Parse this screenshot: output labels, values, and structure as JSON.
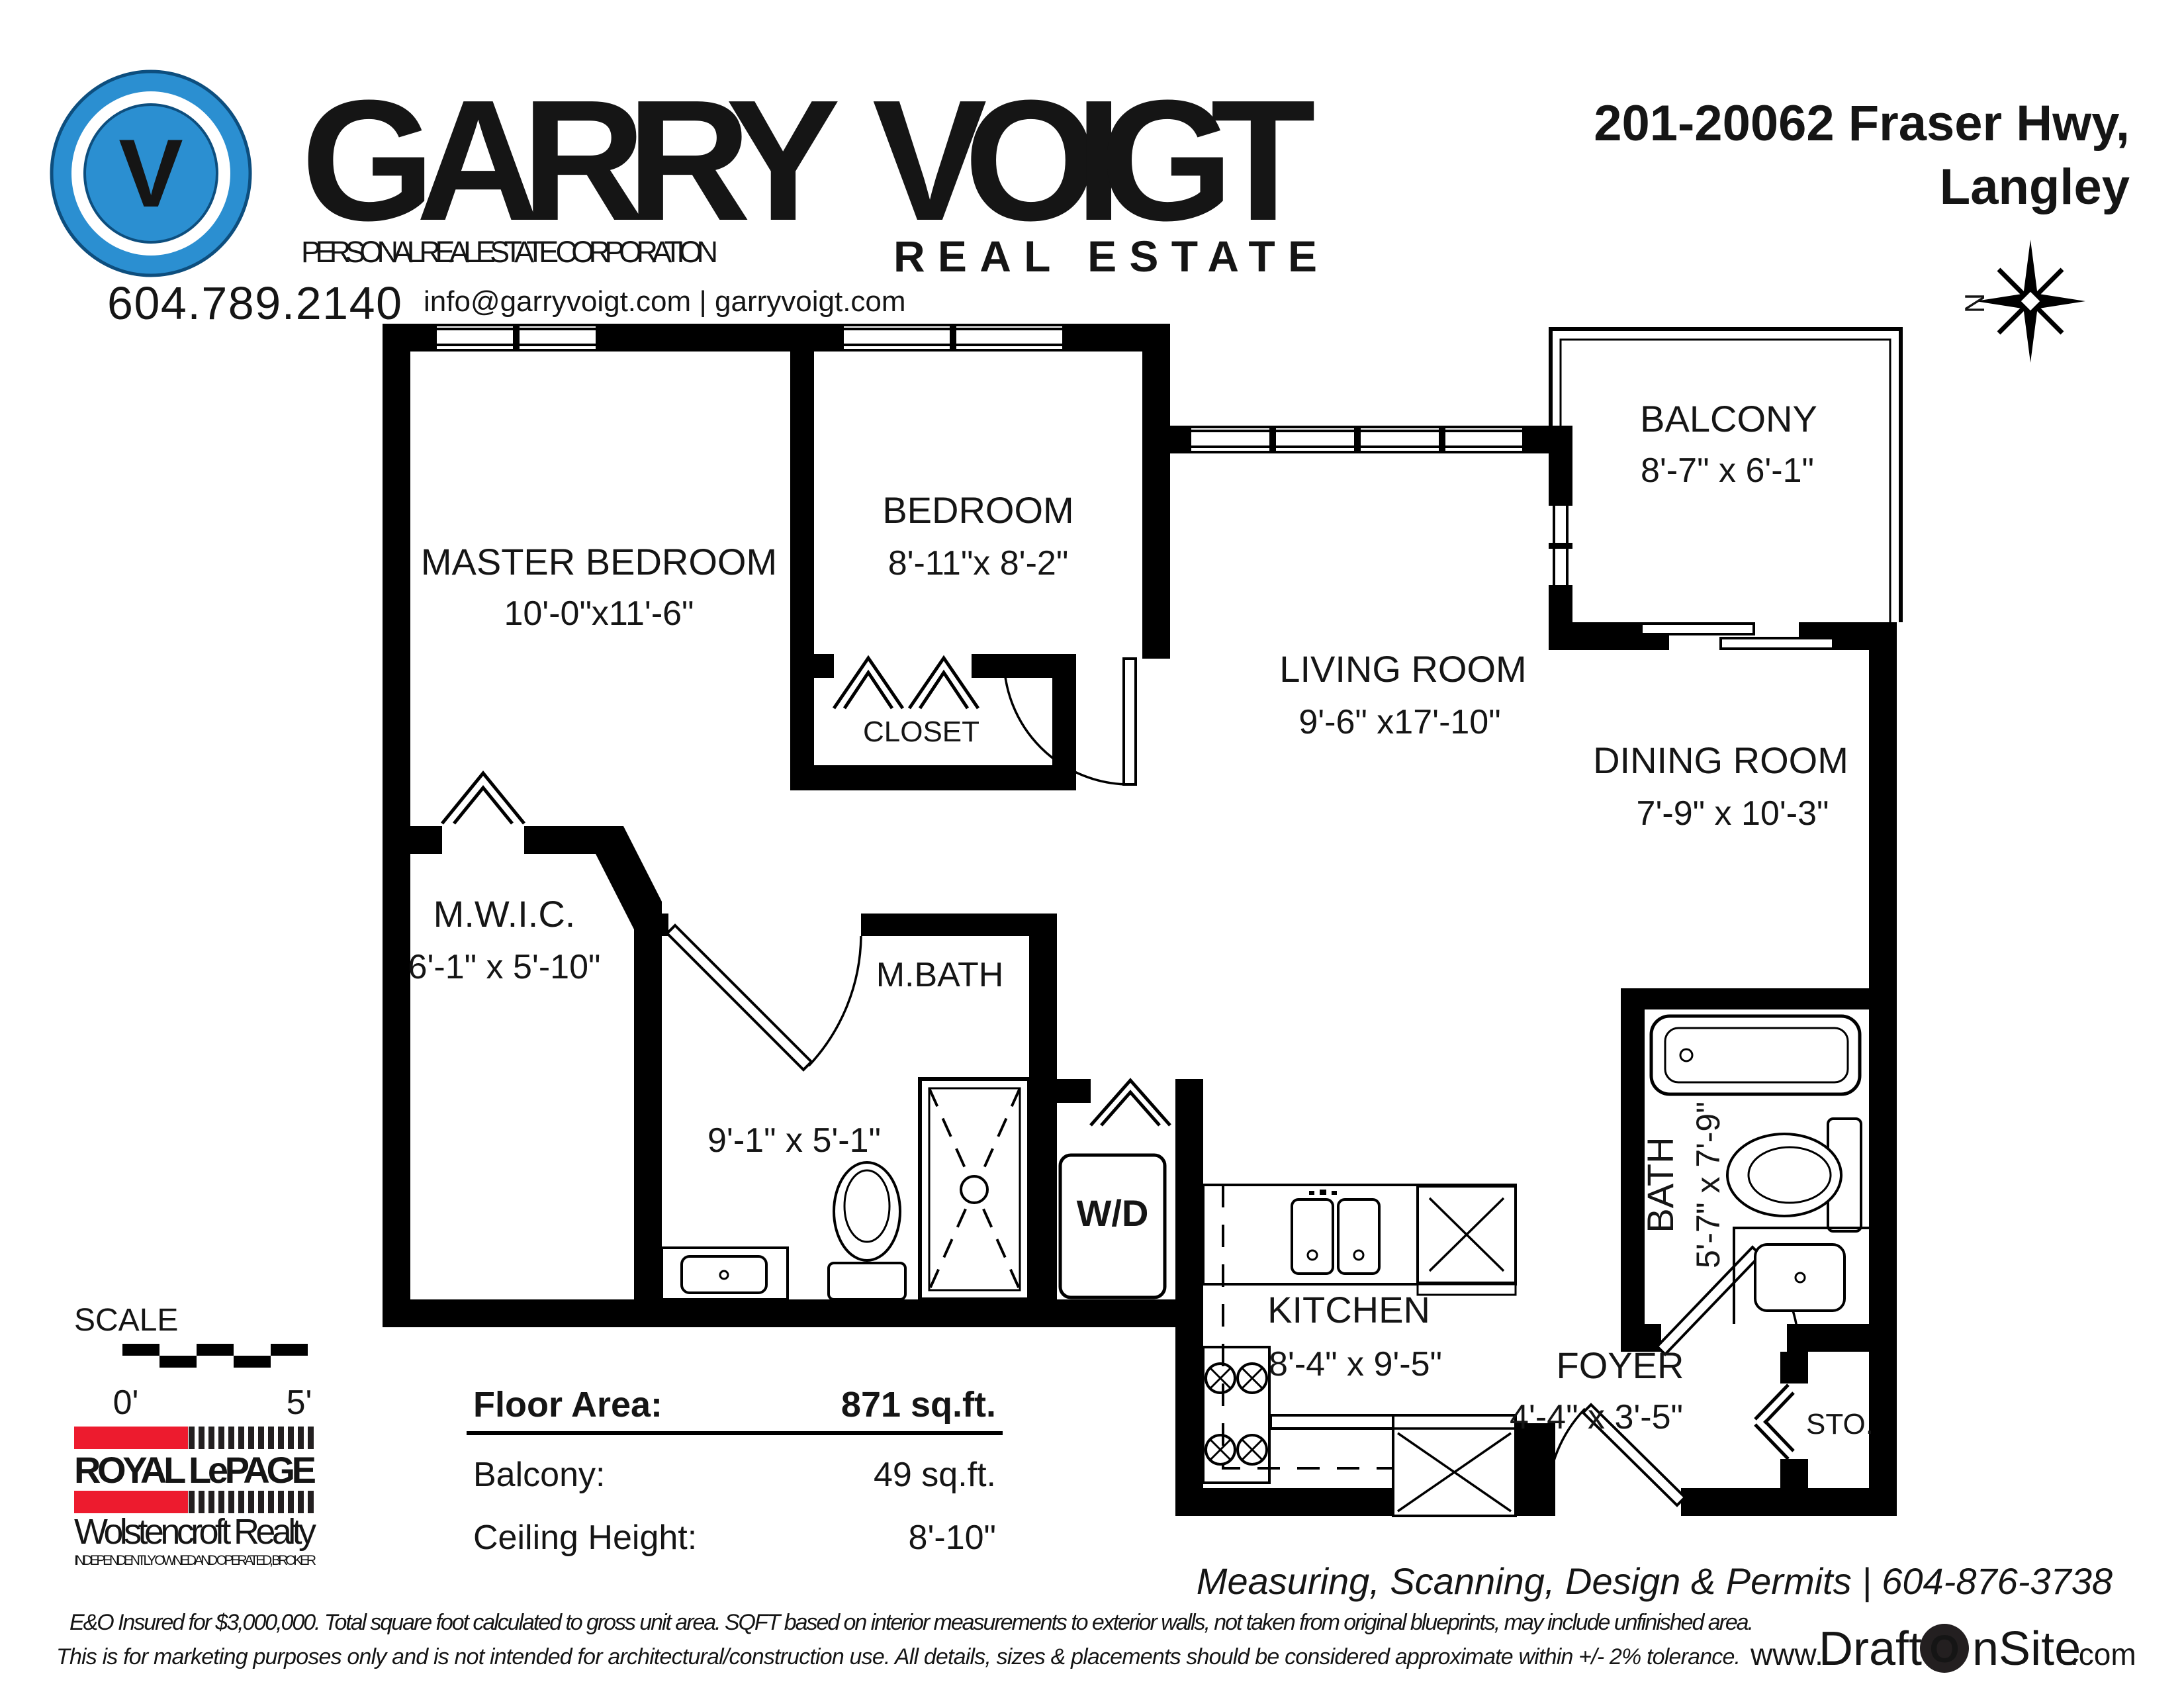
{
  "header": {
    "logo_monogram": "V",
    "brand_first": "GARRY",
    "brand_last": "VOIGT",
    "brand_sub": "PERSONAL REAL ESTATE CORPORATION",
    "brand_tag": "REAL ESTATE",
    "phone": "604.789.2140",
    "contact": "info@garryvoigt.com  |  garryvoigt.com",
    "address_line1": "201-20062 Fraser Hwy,",
    "address_line2": "Langley",
    "compass_n": "N"
  },
  "colors": {
    "brand_blue": "#2b8fd1",
    "royal_red": "#ed1b2e",
    "ink": "#151515"
  },
  "rooms": {
    "master": {
      "name": "MASTER BEDROOM",
      "dims": "10'-0\"x11'-6\""
    },
    "bedroom": {
      "name": "BEDROOM",
      "dims": "8'-11\"x 8'-2\""
    },
    "closet": {
      "name": "CLOSET"
    },
    "living": {
      "name": "LIVING ROOM",
      "dims": "9'-6\" x17'-10\""
    },
    "dining": {
      "name": "DINING ROOM",
      "dims": "7'-9\" x 10'-3\""
    },
    "balcony": {
      "name": "BALCONY",
      "dims": "8'-7\" x 6'-1\""
    },
    "mwic": {
      "name": "M.W.I.C.",
      "dims": "6'-1\" x 5'-10\""
    },
    "mbath": {
      "name": "M.BATH",
      "dims": "9'-1\" x 5'-1\""
    },
    "wd": {
      "name": "W/D"
    },
    "kitchen": {
      "name": "KITCHEN",
      "dims": "8'-4\" x 9'-5\""
    },
    "foyer": {
      "name": "FOYER",
      "dims": "4'-4\" x 3'-5\""
    },
    "bath": {
      "name": "BATH",
      "dims": "5'-7\" x 7'-9\""
    },
    "storage": {
      "name": "STO."
    }
  },
  "scalebar": {
    "label": "SCALE",
    "start": "0'",
    "end": "5'"
  },
  "stats": {
    "floor_area_label": "Floor Area:",
    "floor_area_value": "871 sq.ft.",
    "balcony_label": "Balcony:",
    "balcony_value": "49 sq.ft.",
    "ceiling_label": "Ceiling Height:",
    "ceiling_value": "8'-10\""
  },
  "brokerage": {
    "line1": "ROYAL LePAGE",
    "line2": "Wolstencroft Realty",
    "line3": "INDEPENDENTLY OWNED AND OPERATED, BROKER"
  },
  "footer": {
    "services": "Measuring, Scanning, Design & Permits | 604-876-3738",
    "disclaimer1": "E&O Insured for $3,000,000.  Total square foot calculated to gross unit area. SQFT based on interior measurements to exterior walls, not taken from original blueprints, may include unfinished area.",
    "disclaimer2": "This is for marketing purposes only and is not intended for architectural/construction use.  All details, sizes & placements should be considered approximate within +/- 2%  tolerance.",
    "site_www": "www.",
    "site_a": "Draft",
    "site_o": "O",
    "site_b": "nSite",
    "site_c": ".com"
  }
}
